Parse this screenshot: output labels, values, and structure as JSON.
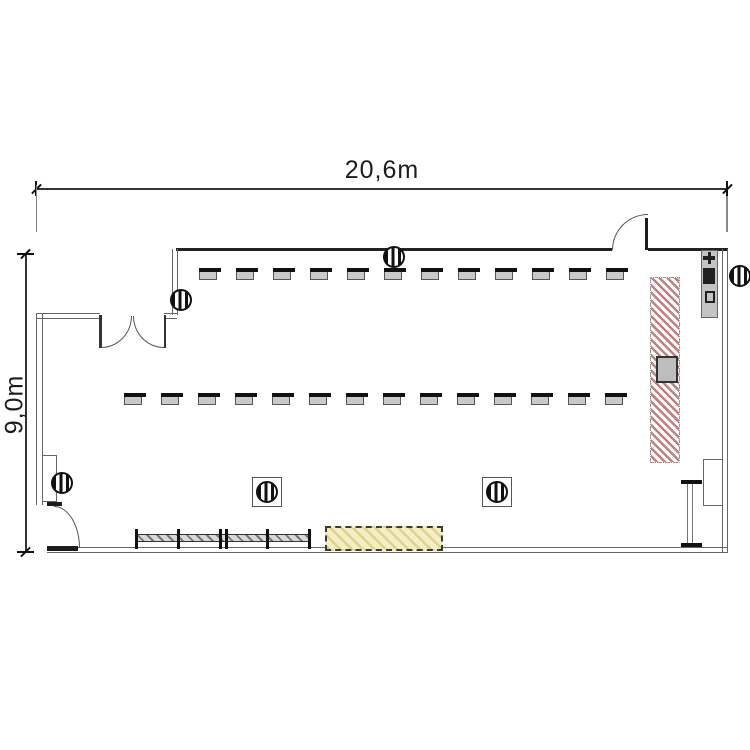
{
  "dimensions": {
    "width_label": "20,6m",
    "height_label": "9,0m"
  },
  "seating": {
    "top_block": {
      "columns": 12,
      "seats_per_column": 5,
      "x": 199,
      "y": 268,
      "col_pitch": 37,
      "seat_pitch": 17
    },
    "bottom_block": {
      "columns": 14,
      "seats_per_column": 5,
      "x": 124,
      "y": 393,
      "col_pitch": 37,
      "seat_pitch": 17
    }
  },
  "symbols": {
    "lights": [
      {
        "x": 181,
        "y": 300
      },
      {
        "x": 394,
        "y": 257
      },
      {
        "x": 740,
        "y": 276
      },
      {
        "x": 62,
        "y": 483
      },
      {
        "x": 267,
        "y": 492
      },
      {
        "x": 497,
        "y": 492
      }
    ]
  },
  "colors": {
    "wall": "#222222",
    "wall_light": "#666666",
    "seat_fill": "#c9c9c9",
    "seat_border": "#555555",
    "backrest": "#111111",
    "red_hatch": "#c08082",
    "yellow_fill": "#f4eec6",
    "yellow_hatch": "#ded28f",
    "gray_fill": "#bdbdbd",
    "dim": "#333333"
  }
}
